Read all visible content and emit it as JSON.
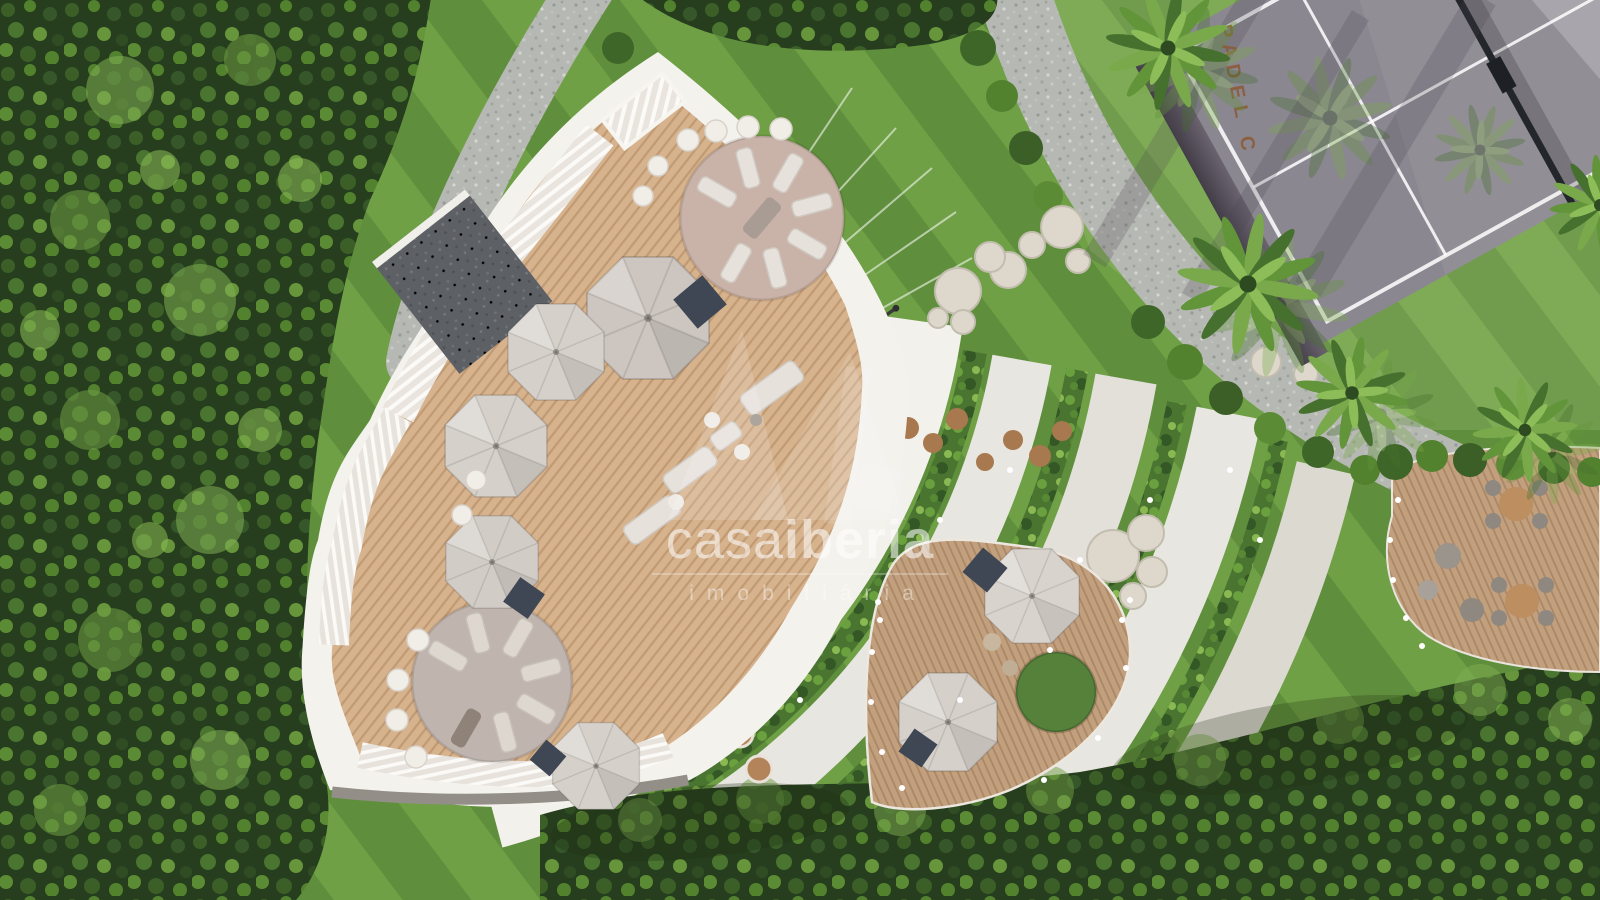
{
  "watermark": {
    "brand_light": "casa",
    "brand_bold": "iberia",
    "subtitle": "imobiliária",
    "color": "#ffffff"
  },
  "padel_court": {
    "sign_text": "PADEL C",
    "sign_color": "#8a5a33"
  },
  "palette": {
    "lawn_light": "#6fa046",
    "lawn_dark": "#5f8f3c",
    "forest_base": "#263e1d",
    "planter_base": "#4a7530",
    "gravel": "#b6b8b3",
    "white_structure": "#f4f2ed",
    "concrete_light": "#e8e6e0",
    "concrete_mid": "#e2e0d9",
    "concrete_deep": "#dcd9d1",
    "walkway": "#f3f1ec",
    "deck_wood": "#d6b28d",
    "deck_wood_stripe": "#c09a73",
    "deck_wood_dark": "#c29f7d",
    "deck_wood_dark_stripe": "#aa8867",
    "lounge_floor_top": "#c9b2a8",
    "lounge_floor_bottom": "#bfb4ae",
    "umbrella": "#d5cfc9",
    "navy_daybed": "#3e4753",
    "court_surface": "#928e96",
    "court_sheen": "#c6c2c9",
    "court_wall": "#423d47",
    "court_line": "#ffffff",
    "teak_table": "#bd8e5f",
    "roof_gravel": "#5d6064"
  }
}
